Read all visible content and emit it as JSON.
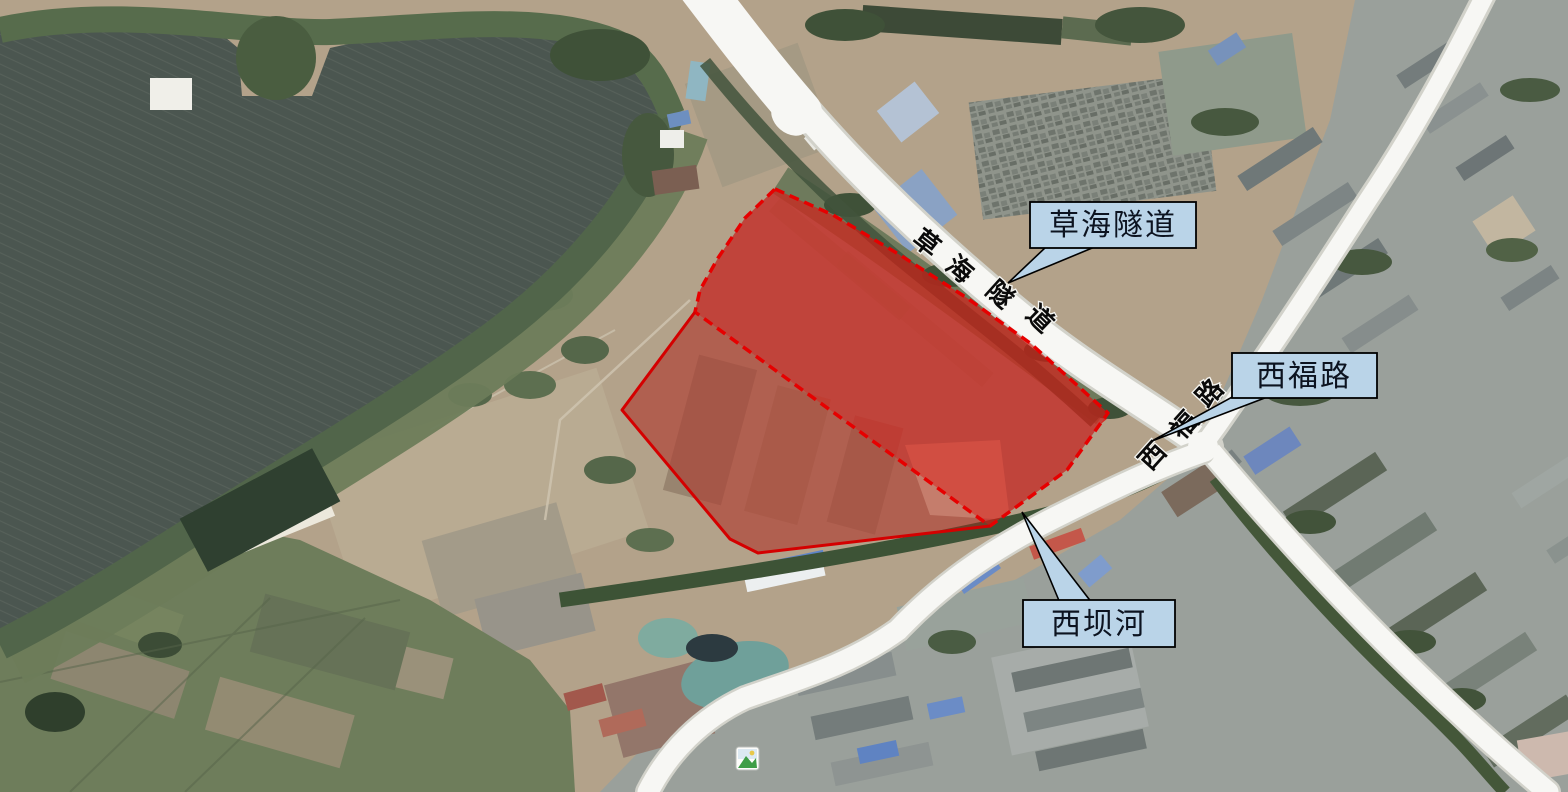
{
  "figure": {
    "kind": "satellite-map-annotation",
    "description_labels_visible": [
      "草海隧道",
      "西福路",
      "西坝河"
    ]
  },
  "callouts": {
    "caohai_tunnel": {
      "text": "草海隧道"
    },
    "xifu_road": {
      "text": "西福路"
    },
    "xibahe_river": {
      "text": "西坝河"
    }
  },
  "road_labels": {
    "caohai_tunnel": {
      "name": "草海隧道",
      "chars": [
        "草",
        "海",
        "隧",
        "道"
      ]
    },
    "xifu_road": {
      "name": "西福路",
      "chars": [
        "西",
        "福",
        "路"
      ]
    }
  },
  "overlay": {
    "bright_polygon_points": "775,189 833,215 900,255 967,298 1030,343 1108,413 1067,470 990,526 695,312 700,290 718,258 745,218",
    "light_polygon_points": "695,312 990,526 758,553 730,539 622,410",
    "light_border_points": "990,526 758,553 730,539 622,410 695,312",
    "border_color": "#e60000",
    "solid_border_color": "#d40000",
    "fill_color": "#e01510"
  },
  "colors": {
    "callout_fill": "#bad4e8",
    "callout_border": "#000000",
    "callout_text": "#0c1320",
    "water": "#4b5650",
    "road": "#f7f7f4",
    "vegetation": "#51654a",
    "farmland": "#6e7d5b",
    "urban": "#9aa09b"
  },
  "icons": {
    "photo_marker": "photo-marker-icon"
  }
}
